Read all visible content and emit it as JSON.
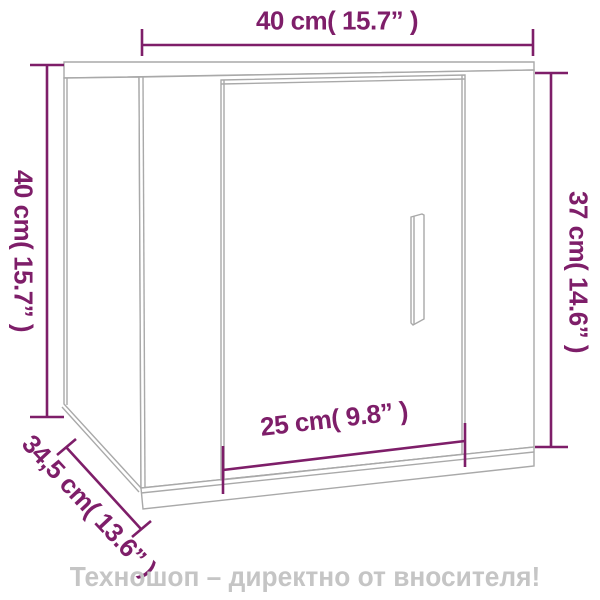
{
  "figure": {
    "type": "product-dimension-diagram",
    "product": "wall-mounted cabinet with door and handle"
  },
  "dimension_labels": {
    "top_width": "40 cm( 15.7” )",
    "left_height": "40 cm( 15.7” )",
    "right_height": "37 cm( 14.6” )",
    "door_width": "25 cm( 9.8” )",
    "depth": "34,5 cm( 13.6” )"
  },
  "footer": {
    "watermark": "Техношоп – директно от вносителя!"
  },
  "colors": {
    "dimension_accent": "#7E1E69",
    "outline_gray": "#A9A9A9",
    "watermark_gray": "#C5C5C5",
    "background": "#FFFFFF"
  }
}
